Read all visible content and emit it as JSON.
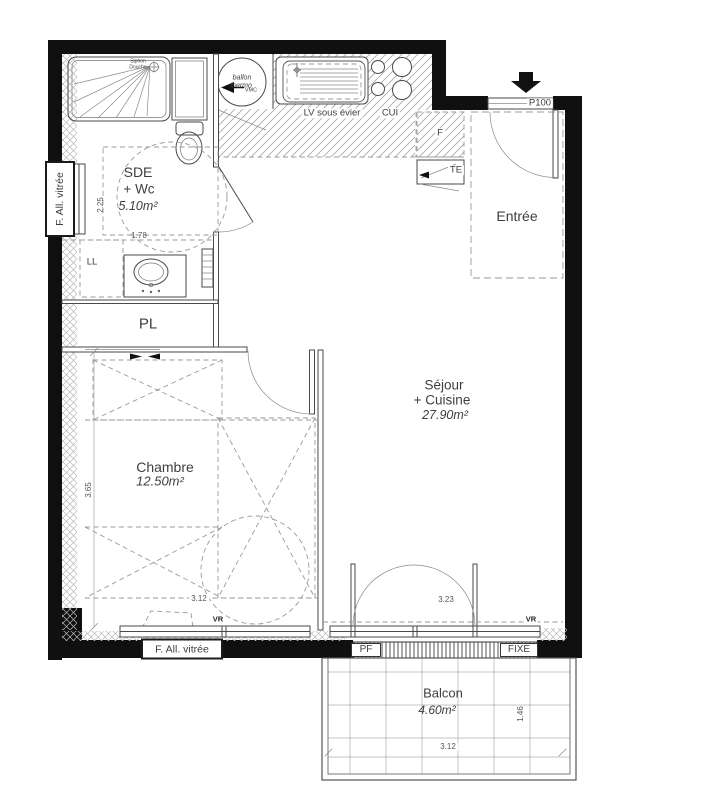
{
  "rooms": {
    "sde": {
      "name_line1": "SDE",
      "name_line2": "+ Wc",
      "area": "5.10m²"
    },
    "entree": {
      "name": "Entrée"
    },
    "sejour": {
      "name_line1": "Séjour",
      "name_line2": "+ Cuisine",
      "area": "27.90m²"
    },
    "chambre": {
      "name": "Chambre",
      "area": "12.50m²"
    },
    "pl": {
      "name": "PL"
    },
    "balcon": {
      "name": "Balcon",
      "area": "4.60m²"
    }
  },
  "fixtures": {
    "ballon_line1": "ballon",
    "ballon_line2": "thermo",
    "vmc": "VMC",
    "siphon_line1": "Siphon",
    "siphon_line2": "Douche",
    "lave_vaisselle": "LV sous évier",
    "cuisine": "CUI",
    "frigo": "F",
    "tableau_electrique": "TE",
    "lave_linge": "LL"
  },
  "openings": {
    "entry_door": "P100",
    "window_left": "F. All. vitrée",
    "window_bottom": "F. All. vitrée",
    "volet_roulant_left": "VR",
    "volet_roulant_right": "VR",
    "porte_fenetre": "PF",
    "fixe": "FIXE"
  },
  "dimensions": {
    "sde_height": "2.25",
    "sde_width": "1.78",
    "chambre_height": "3.65",
    "chambre_width": "3.12",
    "sejour_door_width": "3.23",
    "balcon_height": "1.46",
    "balcon_width": "3.12"
  },
  "colors": {
    "wall": "#101010",
    "line": "#4a4a4a",
    "light_line": "#8a8a8a",
    "dash": "#9a9a9a",
    "text": "#3a3f44"
  }
}
